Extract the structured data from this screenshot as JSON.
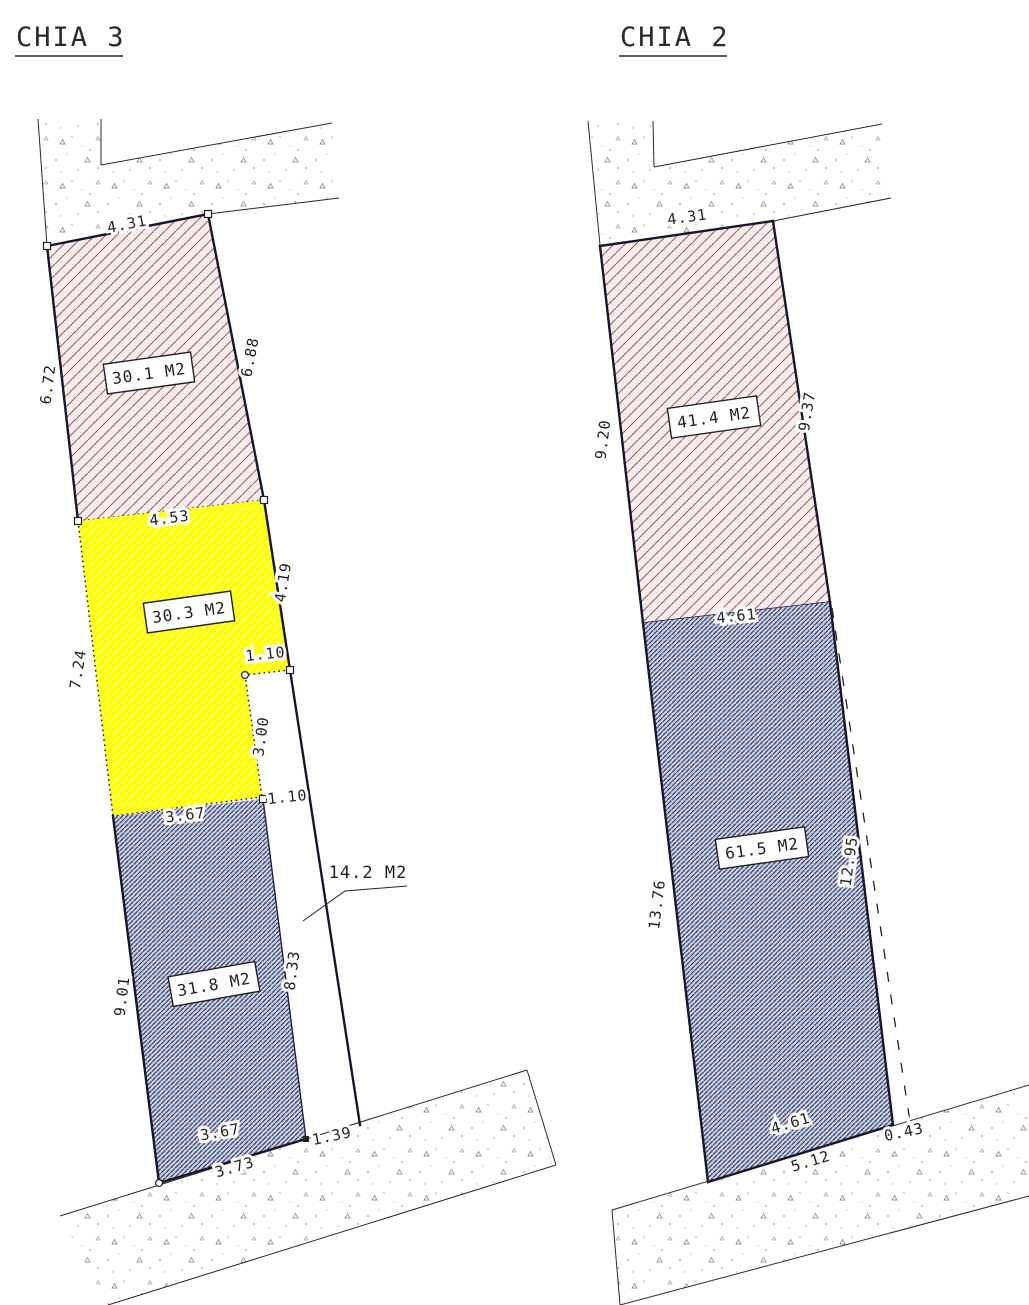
{
  "left_plot": {
    "title": "CHIA 3",
    "areas": {
      "upper": "30.1 M2",
      "middle": "30.3 M2",
      "lower": "31.8 M2",
      "strip": "14.2 M2"
    },
    "dims": {
      "top_width": "4.31",
      "upper_left": "6.72",
      "upper_right": "6.88",
      "middle_width": "4.53",
      "middle_left": "7.24",
      "middle_right": "4.19",
      "notch_top": "1.10",
      "notch_height": "3.00",
      "strip_top": "1.10",
      "lower_top": "3.67",
      "lower_left": "9.01",
      "strip_height": "8.33",
      "lower_bottom": "3.67",
      "bottom_offset": "3.73",
      "bottom_right": "1.39"
    }
  },
  "right_plot": {
    "title": "CHIA 2",
    "areas": {
      "upper": "41.4 M2",
      "lower": "61.5 M2"
    },
    "dims": {
      "top_width": "4.31",
      "upper_left": "9.20",
      "upper_right": "9.37",
      "middle_width": "4.61",
      "lower_left": "13.76",
      "lower_right": "12.95",
      "bottom_width": "4.61",
      "bottom_offset": "5.12",
      "bottom_gap": "0.43"
    }
  },
  "colors": {
    "red_hatch": "#a25c5c",
    "red_fill": "#f8ecec",
    "yellow_fill": "#ffff00",
    "blue_hatch": "#2c3667",
    "blue_fill": "#cdd2e2",
    "stipple_gray": "#8a8a8a",
    "line_dark": "#16162b"
  }
}
